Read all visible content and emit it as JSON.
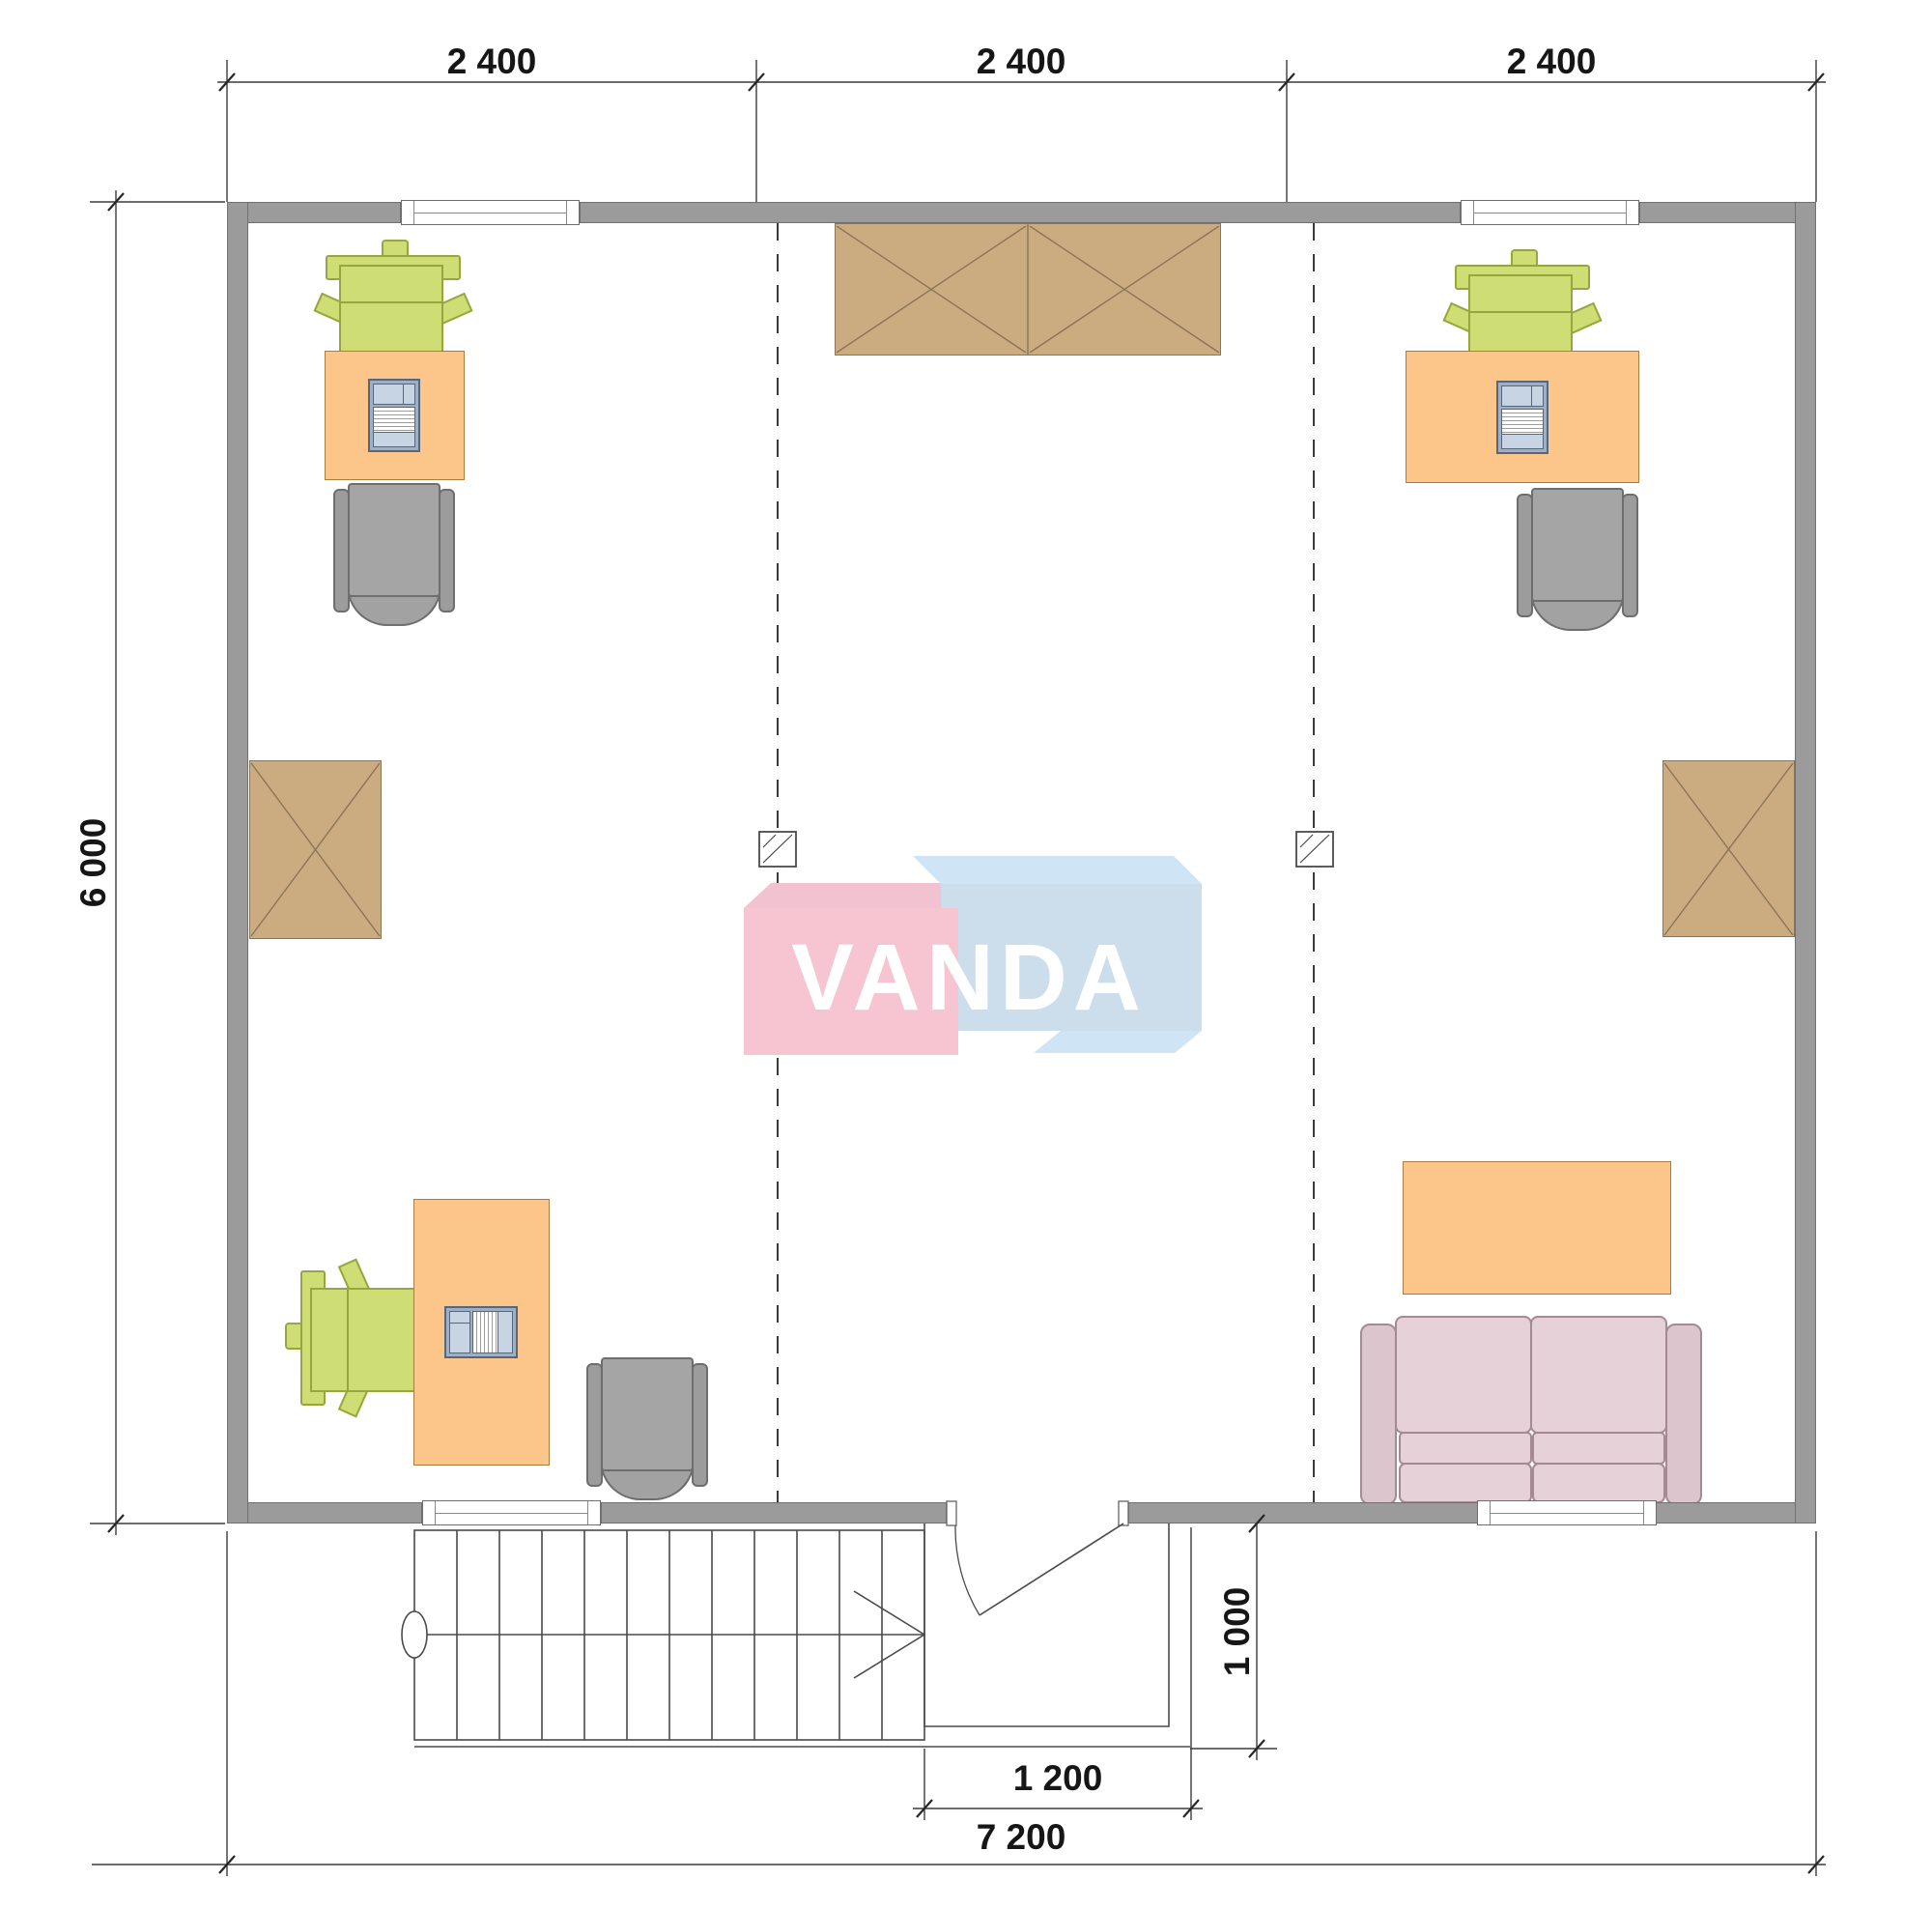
{
  "drawing": {
    "type": "architectural floor plan, top view, office layout with stairs and entry porch"
  },
  "watermark": {
    "text": "VANDA",
    "pink": "#f6c5d1",
    "blue": "#ccddec"
  },
  "dimensions": {
    "top_segments": [
      "2 400",
      "2 400",
      "2 400"
    ],
    "side_height": "6 000",
    "total_width": "7 200",
    "entry_width": "1 200",
    "porch_depth": "1 000"
  },
  "colors": {
    "wall": "#9b9b9b",
    "wall_outline": "#707070",
    "desk": "#fcc589",
    "desk_outline": "#aa7e42",
    "chair_green": "#cfdd75",
    "chair_green_outline": "#97a63e",
    "chair_gray": "#a2a2a2",
    "chair_gray_outline": "#6e6e6e",
    "storage_box": "#cbab80",
    "storage_box_outline": "#8b7557",
    "sofa": "#e6d1d8",
    "sofa_outline": "#a38a93",
    "laptop": "#9fb0c6",
    "dimension_lines": "#3c3c3c",
    "dimension_text": "#161616"
  }
}
